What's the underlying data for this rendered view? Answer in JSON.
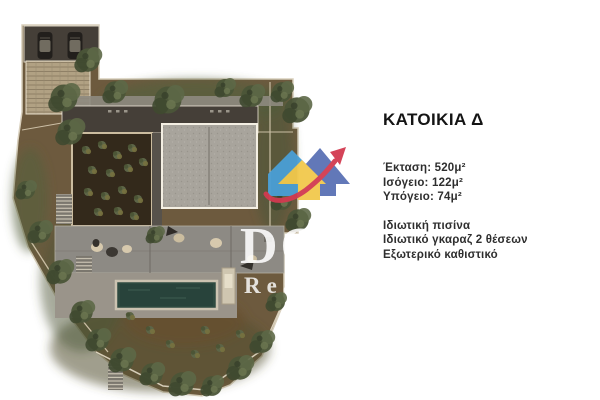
{
  "panel": {
    "title": "ΚΑΤΟΙΚΙΑ Δ",
    "stats": [
      "Έκταση: 520μ²",
      "Ισόγειο: 122μ²",
      "Υπόγειο: 74μ²"
    ],
    "features": [
      "Ιδιωτική πισίνα",
      "Ιδιωτικό γκαραζ 2 θέσεων",
      "Εξωτερικό καθιστικό"
    ]
  },
  "watermark": {
    "line1": "DO",
    "line2": "Real E",
    "logo": {
      "light_blue": "#4a9fd6",
      "indigo": "#5a71b5",
      "yellow": "#f2c94c",
      "red": "#d23a50"
    }
  },
  "plan": {
    "description": "site-plan-residence-d",
    "colors": {
      "soil": "#6d5a3e",
      "vegetation": "#4e5839",
      "roof_dark": "#453f38",
      "roof_gravel": "#a8a49c",
      "terrace": "#8d8a84",
      "pool": "#2e4a40",
      "stone": "#b1a183",
      "boundary": "#d8cfbc"
    },
    "icons": {
      "tree": "tree-icon",
      "car": "car-icon",
      "logo_house": "house-logo-icon",
      "logo_arrow": "growth-arrow-icon"
    }
  }
}
